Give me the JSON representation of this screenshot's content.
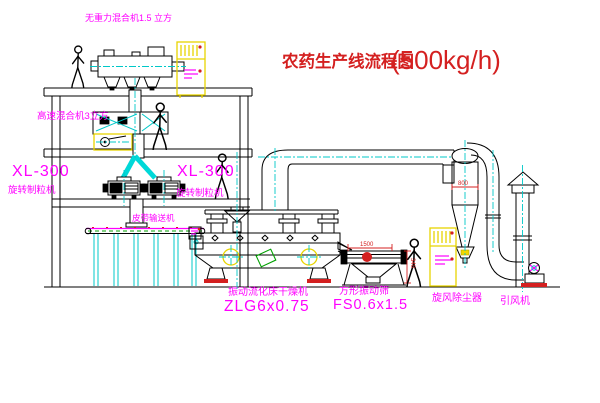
{
  "drawing": {
    "title_zh": "农药生产线流程图",
    "title_capacity": "(500kg/h)",
    "labels": {
      "top_mixer": "无重力混合机1.5 立方",
      "high_speed_mixer": "高速混合机3立方",
      "granulator_left_model": "XL-300",
      "granulator_left_name": "旋转制粒机",
      "granulator_right_model": "XL-300",
      "granulator_right_name": "旋转制粒机",
      "belt_conveyor": "皮带输送机",
      "dryer_name": "振动流化床干燥机",
      "dryer_model": "ZLG6x0.75",
      "screen_name": "方形振动筛",
      "screen_model": "FS0.6x1.5",
      "cyclone_name": "旋风除尘器",
      "fan_name": "引风机"
    },
    "dimensions": {
      "screen_length": "1500",
      "screen_height": "340",
      "cyclone_dim": "800"
    },
    "colors": {
      "label_magenta": "#ff00ff",
      "title_red": "#d42020",
      "centerline_cyan": "#00c8c8",
      "equipment_yellow": "#e8d400",
      "conveyor_green": "#00a000",
      "line_black": "#000000",
      "background": "#ffffff"
    }
  }
}
